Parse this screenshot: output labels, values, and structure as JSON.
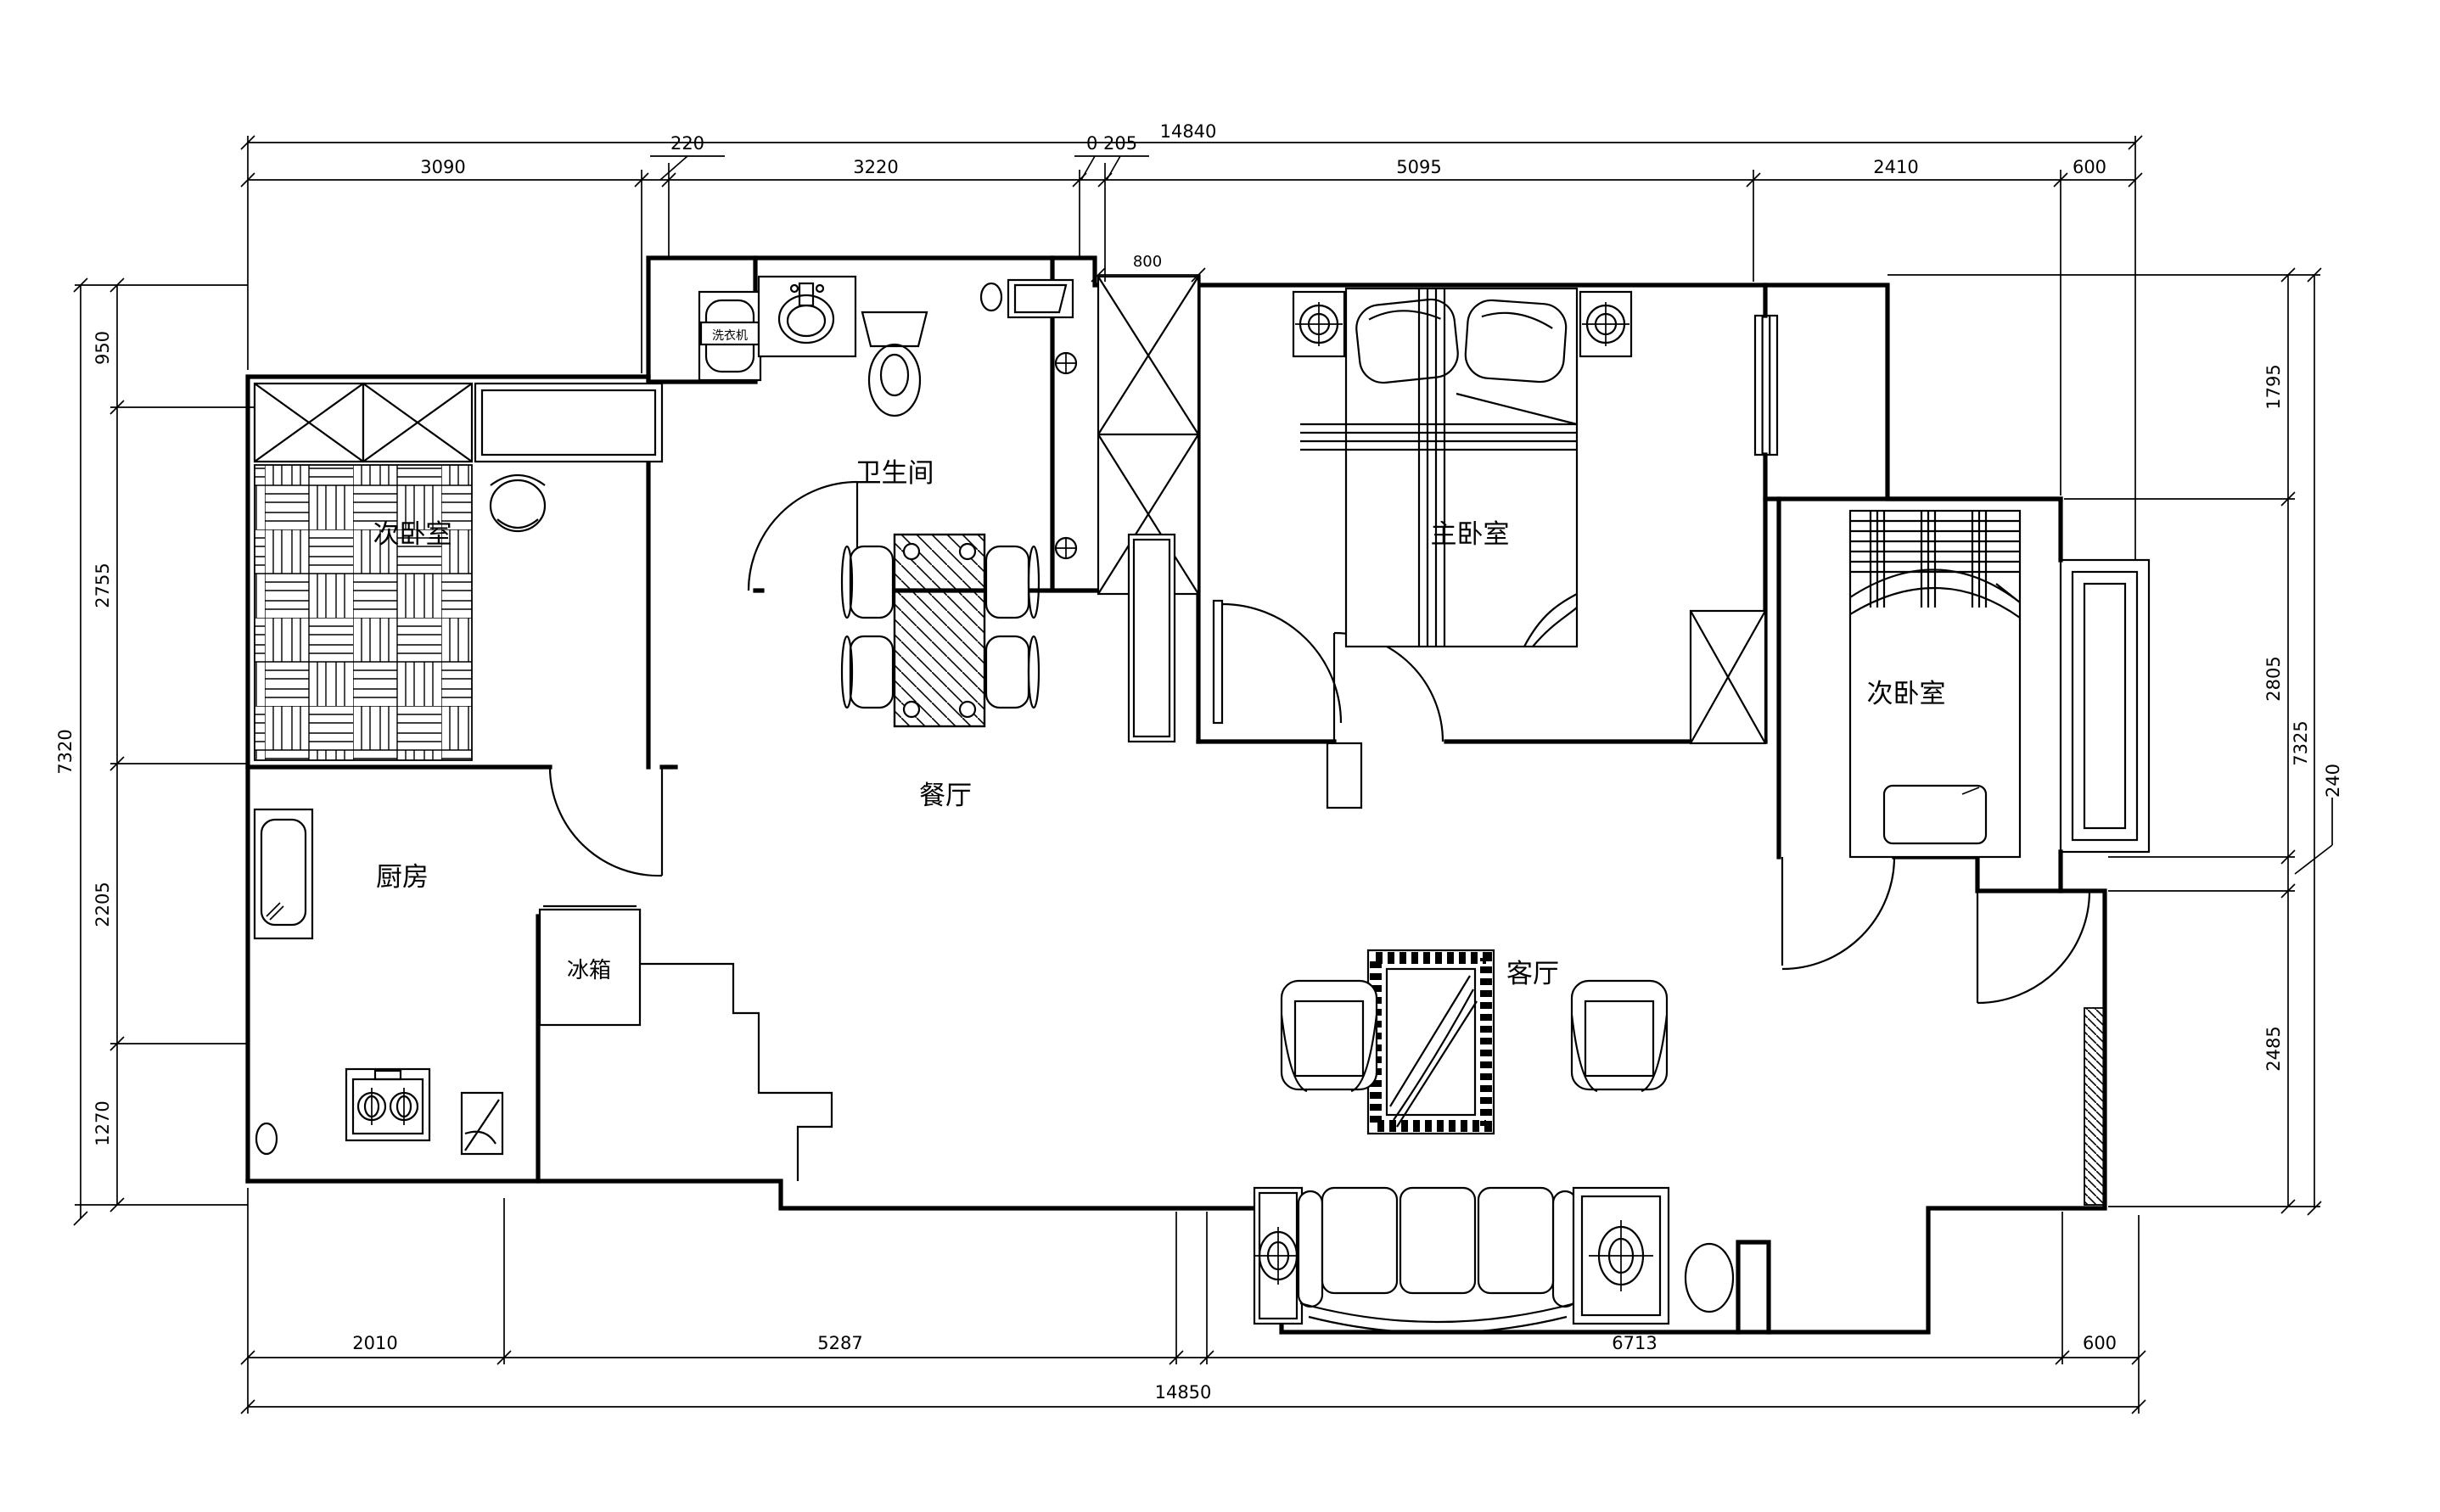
{
  "drawing": {
    "rooms": {
      "bathroom": "卫生间",
      "master_bedroom": "主卧室",
      "bedroom_left": "次卧室",
      "bedroom_right": "次卧室",
      "kitchen": "厨房",
      "dining": "餐厅",
      "living": "客厅"
    },
    "appliances": {
      "fridge": "冰箱",
      "washer": "洗衣机"
    },
    "dims": {
      "top": {
        "overall": "14840",
        "offset_a": "220",
        "offset_b": "0 205",
        "segments": [
          "3090",
          "3220",
          "5095",
          "2410",
          "600"
        ]
      },
      "bottom": {
        "overall": "14850",
        "segments": [
          "2010",
          "5287",
          "6713",
          "600"
        ]
      },
      "left": {
        "overall": "7320",
        "segments": [
          "950",
          "2755",
          "2205",
          "1270"
        ]
      },
      "right": {
        "overall": "7325",
        "offset": "240",
        "segments": [
          "1795",
          "2805",
          "2485"
        ]
      },
      "interior": {
        "shaft_width": "800"
      }
    }
  }
}
